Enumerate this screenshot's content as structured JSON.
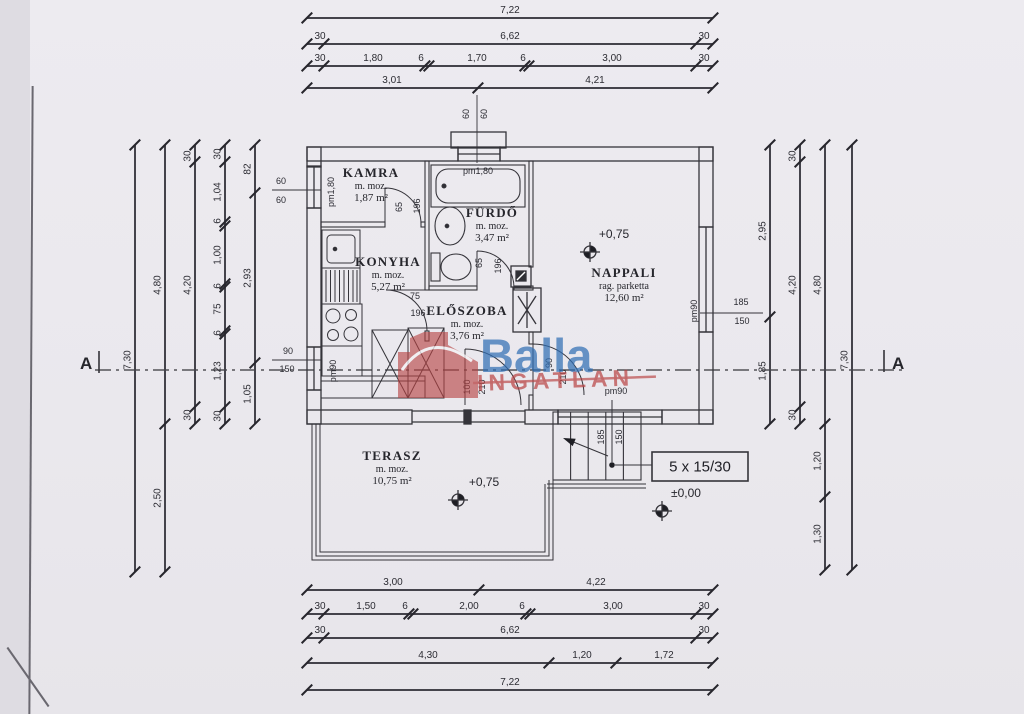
{
  "page": {
    "background": "#eae8ed"
  },
  "logo": {
    "brand": "Balla",
    "word": "INGATLAN",
    "brand_color": "#2e6db4",
    "accent_color": "#b84343"
  },
  "section_marks": {
    "left": "A",
    "right": "A"
  },
  "rooms": {
    "kamra": {
      "name": "KAMRA",
      "finish": "m. moz.",
      "area": "1,87 m²"
    },
    "furdo": {
      "name": "FÜRDŐ",
      "finish": "m. moz.",
      "area": "3,47 m²"
    },
    "konyha": {
      "name": "KONYHA",
      "finish": "m. moz.",
      "area": "5,27 m²"
    },
    "eloszoba": {
      "name": "ELŐSZOBA",
      "finish": "m. moz.",
      "area": "3,76 m²"
    },
    "nappali": {
      "name": "NAPPALI",
      "finish": "rag. parketta",
      "area": "12,60 m²"
    },
    "terasz": {
      "name": "TERASZ",
      "finish": "m. moz.",
      "area": "10,75 m²"
    }
  },
  "levels": {
    "nappali": "+0,75",
    "terasz": "+0,75",
    "entry": "±0,00"
  },
  "stairs": {
    "label": "5 x 15/30"
  },
  "dimensions": {
    "chains": [
      {
        "o": "h",
        "x": 307,
        "y": 18,
        "len": 406,
        "ticks": [
          0,
          406
        ],
        "labels": [
          {
            "t": "7,22",
            "at": 203
          }
        ]
      },
      {
        "o": "h",
        "x": 307,
        "y": 44,
        "len": 406,
        "ticks": [
          0,
          17,
          389,
          406
        ],
        "labels": [
          {
            "t": "30",
            "at": 13
          },
          {
            "t": "6,62",
            "at": 203
          },
          {
            "t": "30",
            "at": 397
          }
        ]
      },
      {
        "o": "h",
        "x": 307,
        "y": 66,
        "len": 406,
        "ticks": [
          0,
          17,
          118,
          122,
          218,
          222,
          389,
          406
        ],
        "labels": [
          {
            "t": "30",
            "at": 13
          },
          {
            "t": "1,80",
            "at": 66
          },
          {
            "t": "6",
            "at": 114
          },
          {
            "t": "1,70",
            "at": 170
          },
          {
            "t": "6",
            "at": 216
          },
          {
            "t": "3,00",
            "at": 305
          },
          {
            "t": "30",
            "at": 397
          }
        ]
      },
      {
        "o": "h",
        "x": 307,
        "y": 88,
        "len": 406,
        "ticks": [
          0,
          171,
          406
        ],
        "labels": [
          {
            "t": "3,01",
            "at": 85
          },
          {
            "t": "4,21",
            "at": 288
          }
        ]
      },
      {
        "o": "h",
        "x": 307,
        "y": 590,
        "len": 406,
        "ticks": [
          0,
          172,
          406
        ],
        "labels": [
          {
            "t": "3,00",
            "at": 86
          },
          {
            "t": "4,22",
            "at": 289
          }
        ]
      },
      {
        "o": "h",
        "x": 307,
        "y": 614,
        "len": 406,
        "ticks": [
          0,
          17,
          102,
          106,
          219,
          223,
          389,
          406
        ],
        "labels": [
          {
            "t": "30",
            "at": 13
          },
          {
            "t": "1,50",
            "at": 59
          },
          {
            "t": "6",
            "at": 98
          },
          {
            "t": "2,00",
            "at": 162
          },
          {
            "t": "6",
            "at": 215
          },
          {
            "t": "3,00",
            "at": 306
          },
          {
            "t": "30",
            "at": 397
          }
        ]
      },
      {
        "o": "h",
        "x": 307,
        "y": 638,
        "len": 406,
        "ticks": [
          0,
          17,
          389,
          406
        ],
        "labels": [
          {
            "t": "30",
            "at": 13
          },
          {
            "t": "6,62",
            "at": 203
          },
          {
            "t": "30",
            "at": 397
          }
        ]
      },
      {
        "o": "h",
        "x": 307,
        "y": 663,
        "len": 406,
        "ticks": [
          0,
          242,
          309,
          406
        ],
        "labels": [
          {
            "t": "4,30",
            "at": 121
          },
          {
            "t": "1,20",
            "at": 275
          },
          {
            "t": "1,72",
            "at": 357
          }
        ]
      },
      {
        "o": "h",
        "x": 307,
        "y": 690,
        "len": 406,
        "ticks": [
          0,
          406
        ],
        "labels": [
          {
            "t": "7,22",
            "at": 203
          }
        ]
      },
      {
        "o": "v",
        "x": 135,
        "y": 145,
        "len": 427,
        "ticks": [
          0,
          427
        ],
        "labels": [
          {
            "t": "7,30",
            "at": 215
          }
        ]
      },
      {
        "o": "v",
        "x": 165,
        "y": 145,
        "len": 427,
        "ticks": [
          0,
          279,
          427
        ],
        "labels": [
          {
            "t": "4,80",
            "at": 140
          },
          {
            "t": "2,50",
            "at": 353
          }
        ]
      },
      {
        "o": "v",
        "x": 195,
        "y": 145,
        "len": 279,
        "ticks": [
          0,
          17,
          262,
          279
        ],
        "labels": [
          {
            "t": "30",
            "at": 11
          },
          {
            "t": "4,20",
            "at": 140
          },
          {
            "t": "30",
            "at": 270
          }
        ]
      },
      {
        "o": "v",
        "x": 225,
        "y": 145,
        "len": 279,
        "ticks": [
          0,
          17,
          77,
          81,
          139,
          142,
          186,
          189,
          262,
          279
        ],
        "labels": [
          {
            "t": "30",
            "at": 9
          },
          {
            "t": "1,04",
            "at": 47
          },
          {
            "t": "6",
            "at": 76
          },
          {
            "t": "1,00",
            "at": 110
          },
          {
            "t": "6",
            "at": 141
          },
          {
            "t": "75",
            "at": 164
          },
          {
            "t": "6",
            "at": 188
          },
          {
            "t": "1,23",
            "at": 226
          },
          {
            "t": "30",
            "at": 271
          }
        ]
      },
      {
        "o": "v",
        "x": 255,
        "y": 145,
        "len": 279,
        "ticks": [
          0,
          48,
          218,
          279
        ],
        "labels": [
          {
            "t": "82",
            "at": 24
          },
          {
            "t": "2,93",
            "at": 133
          },
          {
            "t": "1,05",
            "at": 249
          }
        ]
      },
      {
        "o": "v",
        "x": 770,
        "y": 145,
        "len": 279,
        "ticks": [
          0,
          172,
          279
        ],
        "labels": [
          {
            "t": "2,95",
            "at": 86
          },
          {
            "t": "1,85",
            "at": 226
          }
        ]
      },
      {
        "o": "v",
        "x": 800,
        "y": 145,
        "len": 279,
        "ticks": [
          0,
          17,
          262,
          279
        ],
        "labels": [
          {
            "t": "30",
            "at": 11
          },
          {
            "t": "4,20",
            "at": 140
          },
          {
            "t": "30",
            "at": 270
          }
        ]
      },
      {
        "o": "v",
        "x": 825,
        "y": 145,
        "len": 425,
        "ticks": [
          0,
          279,
          352,
          425
        ],
        "labels": [
          {
            "t": "4,80",
            "at": 140
          },
          {
            "t": "1,20",
            "at": 316
          },
          {
            "t": "1,30",
            "at": 389
          }
        ]
      },
      {
        "o": "v",
        "x": 852,
        "y": 145,
        "len": 425,
        "ticks": [
          0,
          425
        ],
        "labels": [
          {
            "t": "7,30",
            "at": 215
          }
        ]
      }
    ],
    "tags": [
      {
        "t": "pm1,80",
        "x": 331,
        "y": 192,
        "r": -90
      },
      {
        "t": "60",
        "x": 281,
        "y": 181,
        "r": 0
      },
      {
        "t": "60",
        "x": 281,
        "y": 200,
        "r": 0
      },
      {
        "t": "pm90",
        "x": 333,
        "y": 371,
        "r": -90
      },
      {
        "t": "90",
        "x": 288,
        "y": 351,
        "r": 0
      },
      {
        "t": "150",
        "x": 287,
        "y": 369,
        "r": 0
      },
      {
        "t": "pm1,80",
        "x": 478,
        "y": 171,
        "r": 0
      },
      {
        "t": "60",
        "x": 466,
        "y": 114,
        "r": -90
      },
      {
        "t": "60",
        "x": 484,
        "y": 114,
        "r": -90
      },
      {
        "t": "pm90",
        "x": 694,
        "y": 311,
        "r": -90
      },
      {
        "t": "185",
        "x": 741,
        "y": 302,
        "r": 0
      },
      {
        "t": "150",
        "x": 742,
        "y": 321,
        "r": 0
      },
      {
        "t": "pm90",
        "x": 616,
        "y": 391,
        "r": 0
      },
      {
        "t": "185",
        "x": 601,
        "y": 437,
        "r": -90
      },
      {
        "t": "150",
        "x": 619,
        "y": 437,
        "r": -90
      },
      {
        "t": "65",
        "x": 399,
        "y": 207,
        "r": -90
      },
      {
        "t": "196",
        "x": 417,
        "y": 206,
        "r": -90
      },
      {
        "t": "65",
        "x": 479,
        "y": 263,
        "r": -90
      },
      {
        "t": "196",
        "x": 498,
        "y": 266,
        "r": -90
      },
      {
        "t": "75",
        "x": 415,
        "y": 296,
        "r": 0
      },
      {
        "t": "196",
        "x": 418,
        "y": 313,
        "r": 0
      },
      {
        "t": "100",
        "x": 467,
        "y": 387,
        "r": -90
      },
      {
        "t": "210",
        "x": 482,
        "y": 387,
        "r": -90
      },
      {
        "t": "90",
        "x": 549,
        "y": 363,
        "r": -90
      },
      {
        "t": "210",
        "x": 563,
        "y": 377,
        "r": -90
      }
    ]
  }
}
